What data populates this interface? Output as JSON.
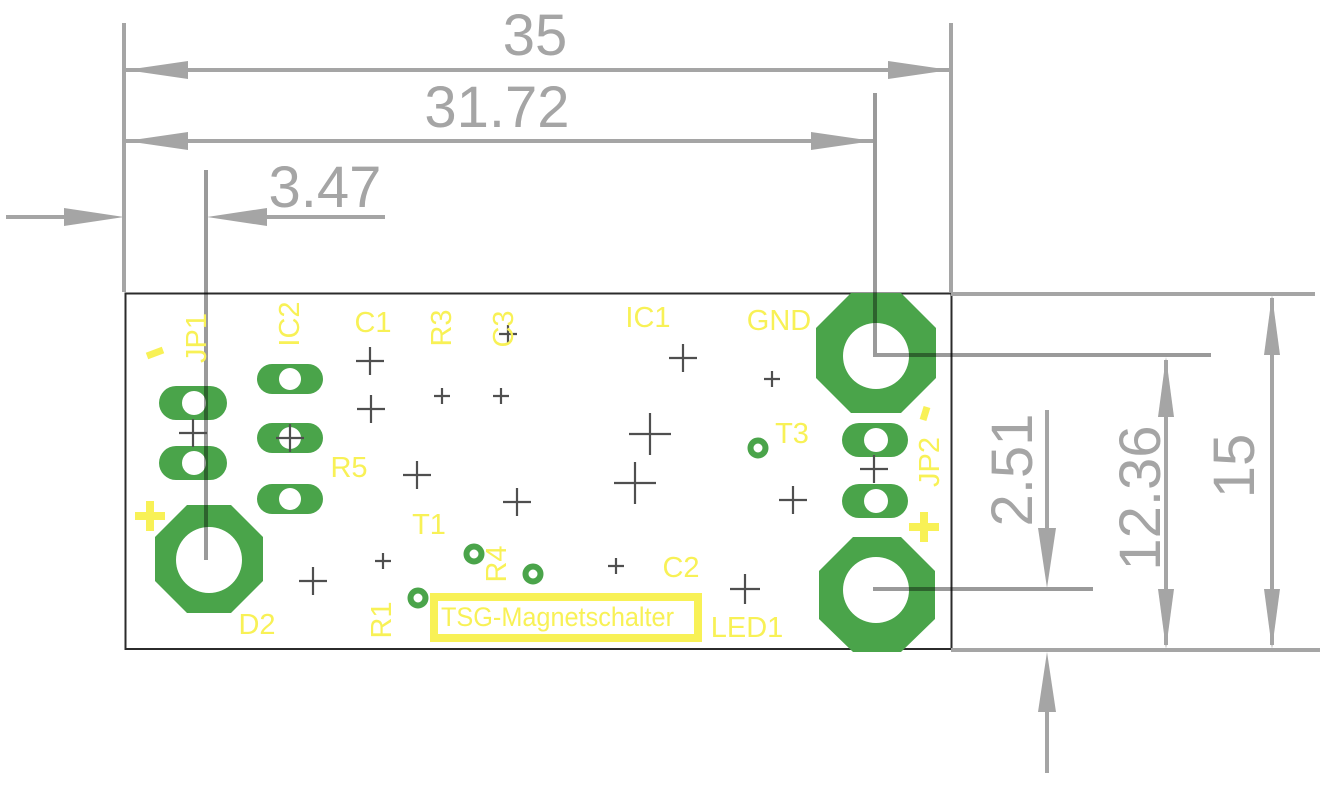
{
  "drawing": {
    "type": "pcb-dimension-drawing",
    "board_name": "TSG-Magnetschalter",
    "dimensions_mm": {
      "total_width": "35",
      "left_edge_to_gnd_hole": "31.72",
      "left_edge_to_plus_hole": "3.47",
      "led_hole_to_bottom_edge": "2.51",
      "gnd_hole_to_bottom_edge": "12.36",
      "total_height": "15"
    },
    "silkscreen": {
      "minus_left": "-",
      "jp1": "JP1",
      "ic2": "IC2",
      "c1": "C1",
      "r3": "R3",
      "c3": "C3",
      "ic1": "IC1",
      "gnd": "GND",
      "t3": "T3",
      "minus_right": "-",
      "jp2": "JP2",
      "plus_left": "+",
      "plus_right": "+",
      "r5": "R5",
      "t1": "T1",
      "r4": "R4",
      "r1": "R1",
      "c2": "C2",
      "d2": "D2",
      "led1": "LED1",
      "title_box": "TSG-Magnetschalter"
    },
    "colors": {
      "pad_green": "#4aa44a",
      "silkscreen_yellow": "#f8f156",
      "dimension_gray": "#a5a5a5",
      "board_outline": "#2b2b2b",
      "drill_cross": "#4f4f4f",
      "background": "#ffffff"
    }
  }
}
